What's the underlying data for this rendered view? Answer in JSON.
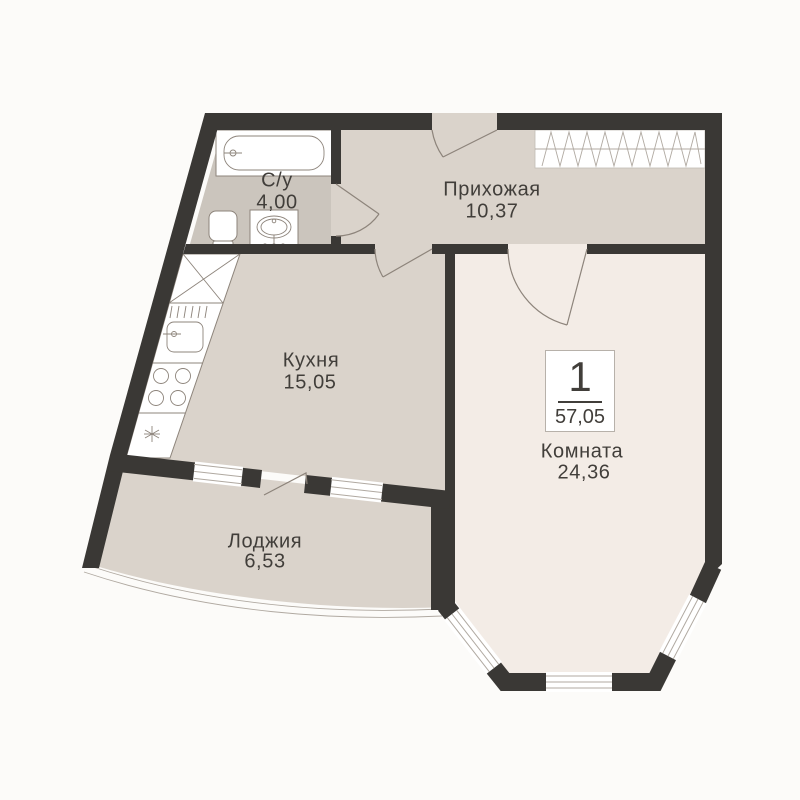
{
  "plan": {
    "title": "one-room apartment floor plan",
    "badge": {
      "number": "1",
      "total_area": "57,05"
    },
    "rooms": [
      {
        "id": "bathroom",
        "name": "С/у",
        "area": "4,00"
      },
      {
        "id": "hallway",
        "name": "Прихожая",
        "area": "10,37"
      },
      {
        "id": "kitchen",
        "name": "Кухня",
        "area": "15,05"
      },
      {
        "id": "room",
        "name": "Комната",
        "area": "24,36"
      },
      {
        "id": "loggia",
        "name": "Лоджия",
        "area": "6,53"
      }
    ],
    "colors": {
      "wall": "#3a3835",
      "floor_main": "#dad3cb",
      "floor_room": "#f3ece6",
      "floor_bath": "#cbc5bd",
      "outline": "#8d847b",
      "background": "#fcfbf9",
      "text": "#413e3a"
    }
  }
}
